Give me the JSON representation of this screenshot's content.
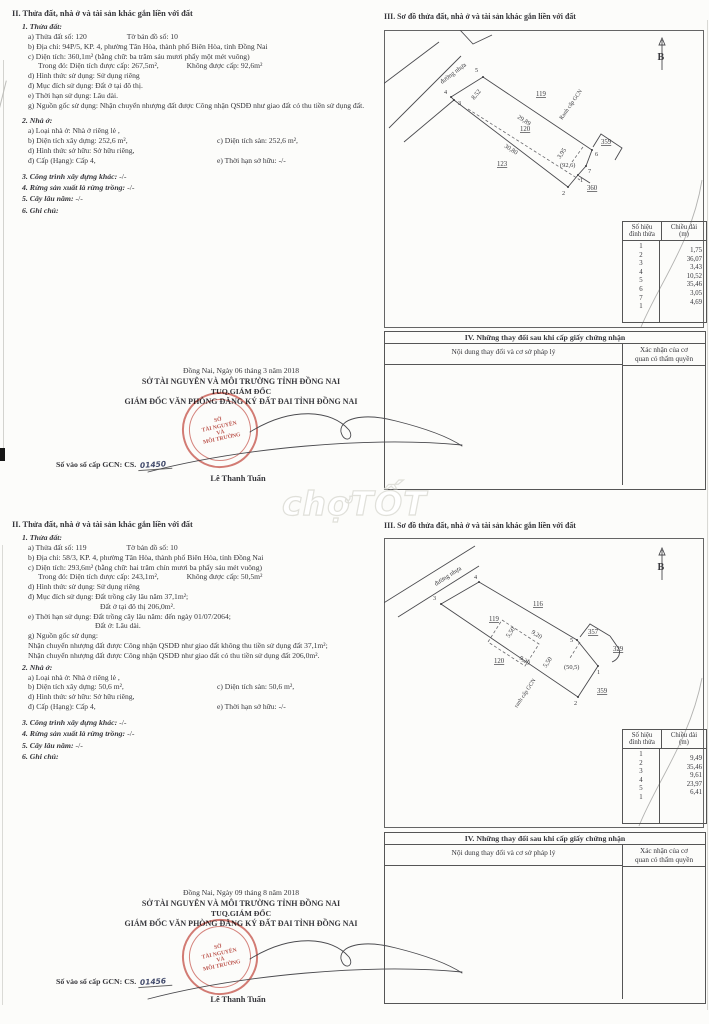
{
  "watermark": {
    "text": "chợTỐT"
  },
  "page1": {
    "sec2": {
      "heading": "II. Thửa đất, nhà ở và tài sản khác gắn liền với đất",
      "s1_title": "1. Thửa đất:",
      "a_left": "a) Thửa đất số:  120",
      "a_right": "Tờ bản đồ số:   10",
      "b": "b) Địa chỉ: 94P/5, KP. 4, phường Tân Hòa, thành phố Biên Hòa, tỉnh Đồng Nai",
      "c": "c) Diện tích: 360,1m² (bằng chữ: ba trăm sáu mươi phẩy một mét vuông)",
      "c2_left": "Trong đó: Diện tích được cấp: 267,5m²,",
      "c2_right": "Không được cấp: 92,6m²",
      "d": "d) Hình thức sử dụng: Sử dụng riêng",
      "dd": "đ) Mục đích sử dụng: Đất ở tại đô thị.",
      "e": "e) Thời hạn sử dụng: Lâu dài.",
      "g": "g) Nguồn gốc sử dụng: Nhận chuyển nhượng đất được Công nhận QSDĐ như giao đất có thu tiền sử dụng đất.",
      "s2_title": "2. Nhà ở:",
      "n_a": "a) Loại nhà ở: Nhà ở riêng lẻ ,",
      "n_b": "b) Diện tích xây dựng: 252,6 m²,",
      "n_c": "c) Diện tích sàn: 252,6 m²,",
      "n_d": "d) Hình thức sở hữu: Sở hữu riêng,",
      "n_dd": "đ) Cấp (Hạng): Cấp 4,",
      "n_e": "e) Thời hạn sở hữu: -/-",
      "s3": "3. Công trình xây dựng khác:",
      "s3_v": "-/-",
      "s4": "4. Rừng sản xuất là rừng trồng:",
      "s4_v": "-/-",
      "s5": "5. Cây lâu năm:",
      "s5_v": "-/-",
      "s6": "6. Ghi chú:"
    },
    "sign": {
      "date": "Đồng Nai, Ngày 06 tháng 3 năm 2018",
      "org": "SỞ TÀI NGUYÊN VÀ MÔI TRƯỜNG TỈNH ĐỒNG NAI",
      "tuq": "TUQ.GIÁM ĐỐC",
      "dir": "GIÁM ĐỐC VĂN PHÒNG ĐĂNG KÝ ĐẤT ĐAI TỈNH ĐỒNG NAI",
      "book_label": "Số vào sổ cấp GCN: CS.",
      "book_no": "01450",
      "signer": "Lê Thanh Tuấn",
      "stamp1": "SỞ",
      "stamp2": "TÀI NGUYÊN",
      "stamp3": "VÀ",
      "stamp4": "MÔI TRƯỜNG"
    },
    "sec3": {
      "heading": "III. Sơ đồ thửa đất, nhà ở và tài sản khác gắn liền với đất",
      "north": "B",
      "road": "đường nhựa",
      "ranh": "Ranh cấp GCN",
      "p119": "119",
      "p120": "120",
      "p123": "123",
      "p359": "359",
      "p360": "360",
      "area": "(92,6)",
      "e1": "8,52",
      "e2": "29,89",
      "e3": "30,80",
      "e4": "3,95",
      "v1": "1",
      "v2": "2",
      "v3": "3",
      "v4": "4",
      "v5": "5",
      "v6": "6",
      "v7": "7"
    },
    "vtable": {
      "h1a": "Số hiệu",
      "h1b": "đỉnh thửa",
      "h2a": "Chiều dài",
      "h2b": "(m)",
      "rows": [
        {
          "v": "1",
          "l": "1,75"
        },
        {
          "v": "2",
          "l": "36,07"
        },
        {
          "v": "3",
          "l": "3,43"
        },
        {
          "v": "4",
          "l": "10,52"
        },
        {
          "v": "5",
          "l": "35,46"
        },
        {
          "v": "6",
          "l": "3,05"
        },
        {
          "v": "7",
          "l": "4,69"
        },
        {
          "v": "1",
          "l": ""
        }
      ]
    },
    "sec4": {
      "heading": "IV. Những thay đổi sau khi cấp giấy chứng nhận",
      "col_a": "Nội dung thay đổi và cơ sở pháp lý",
      "col_b1": "Xác nhận của cơ",
      "col_b2": "quan có thẩm quyền"
    }
  },
  "page2": {
    "sec2": {
      "heading": "II. Thửa đất, nhà ở và tài sản khác gắn liền với đất",
      "s1_title": "1. Thửa đất:",
      "a_left": "a) Thửa đất số:  119",
      "a_right": "Tờ bản đồ số:   10",
      "b": "b) Địa chỉ: 58/3, KP. 4, phường Tân Hòa, thành phố Biên Hòa, tỉnh Đồng Nai",
      "c": "c) Diện tích: 293,6m² (bằng chữ: hai trăm chín mươi ba phẩy sáu mét vuông)",
      "c2_left": "Trong đó: Diện tích được cấp: 243,1m²,",
      "c2_right": "Không được cấp: 50,5m²",
      "d": "d) Hình thức sử dụng: Sử dụng riêng",
      "dd1": "đ) Mục đích sử dụng: Đất trồng cây lâu năm 37,1m²;",
      "dd2": "Đất ở tại đô thị 206,0m².",
      "e1": "e) Thời hạn sử dụng: Đất trồng cây lâu năm: đến ngày 01/07/2064;",
      "e2": "Đất ở: Lâu dài.",
      "g0": "g) Nguồn gốc sử dụng:",
      "g1": "Nhận chuyển nhượng đất được Công nhận QSDĐ như giao đất không thu tiền sử dụng đất 37,1m²;",
      "g2": "Nhận chuyển nhượng đất được Công nhận QSDĐ như giao đất có thu tiền sử dụng đất 206,0m².",
      "s2_title": "2. Nhà ở:",
      "n_a": "a) Loại nhà ở: Nhà ở riêng lẻ ,",
      "n_b": "b) Diện tích xây dựng: 50,6 m²,",
      "n_c": "c) Diện tích sàn: 50,6 m²,",
      "n_d": "d) Hình thức sở hữu: Sở hữu riêng,",
      "n_dd": "đ) Cấp (Hạng): Cấp 4,",
      "n_e": "e) Thời hạn sở hữu: -/-",
      "s3": "3. Công trình xây dựng khác:",
      "s3_v": "-/-",
      "s4": "4. Rừng sản xuất là rừng trồng:",
      "s4_v": "-/-",
      "s5": "5. Cây lâu năm:",
      "s5_v": "-/-",
      "s6": "6. Ghi chú:"
    },
    "sign": {
      "date": "Đồng Nai, Ngày 09 tháng 8 năm 2018",
      "org": "SỞ TÀI NGUYÊN VÀ MÔI TRƯỜNG TỈNH ĐỒNG NAI",
      "tuq": "TUQ.GIÁM ĐỐC",
      "dir": "GIÁM ĐỐC VĂN PHÒNG ĐĂNG KÝ ĐẤT ĐAI TỈNH ĐỒNG NAI",
      "book_label": "Số vào sổ cấp GCN: CS.",
      "book_no": "01456",
      "signer": "Lê Thanh Tuấn",
      "stamp1": "SỞ",
      "stamp2": "TÀI NGUYÊN",
      "stamp3": "VÀ",
      "stamp4": "MÔI TRƯỜNG"
    },
    "sec3": {
      "heading": "III. Sơ đồ thửa đất, nhà ở và tài sản khác gắn liền với đất",
      "north": "B",
      "road": "đường nhựa",
      "ranh": "ranh cấp GCN",
      "p116": "116",
      "p119": "119",
      "p120": "120",
      "p357": "357",
      "p329": "329",
      "p359": "359",
      "area": "(50,5)",
      "e1": "5,50",
      "e2": "9,20",
      "e3": "9,20",
      "e4": "5,50",
      "v1": "1",
      "v2": "2",
      "v3": "3",
      "v4": "4",
      "v5": "5"
    },
    "vtable": {
      "h1a": "Số hiệu",
      "h1b": "đỉnh thửa",
      "h2a": "Chiều dài",
      "h2b": "(m)",
      "rows": [
        {
          "v": "1",
          "l": "9,49"
        },
        {
          "v": "2",
          "l": "35,46"
        },
        {
          "v": "3",
          "l": "9,61"
        },
        {
          "v": "4",
          "l": "23,97"
        },
        {
          "v": "5",
          "l": "6,41"
        },
        {
          "v": "1",
          "l": ""
        }
      ]
    },
    "sec4": {
      "heading": "IV. Những thay đổi sau khi cấp giấy chứng nhận",
      "col_a": "Nội dung thay đổi và cơ sở pháp lý",
      "col_b1": "Xác nhận của cơ",
      "col_b2": "quan có thẩm quyền"
    }
  }
}
